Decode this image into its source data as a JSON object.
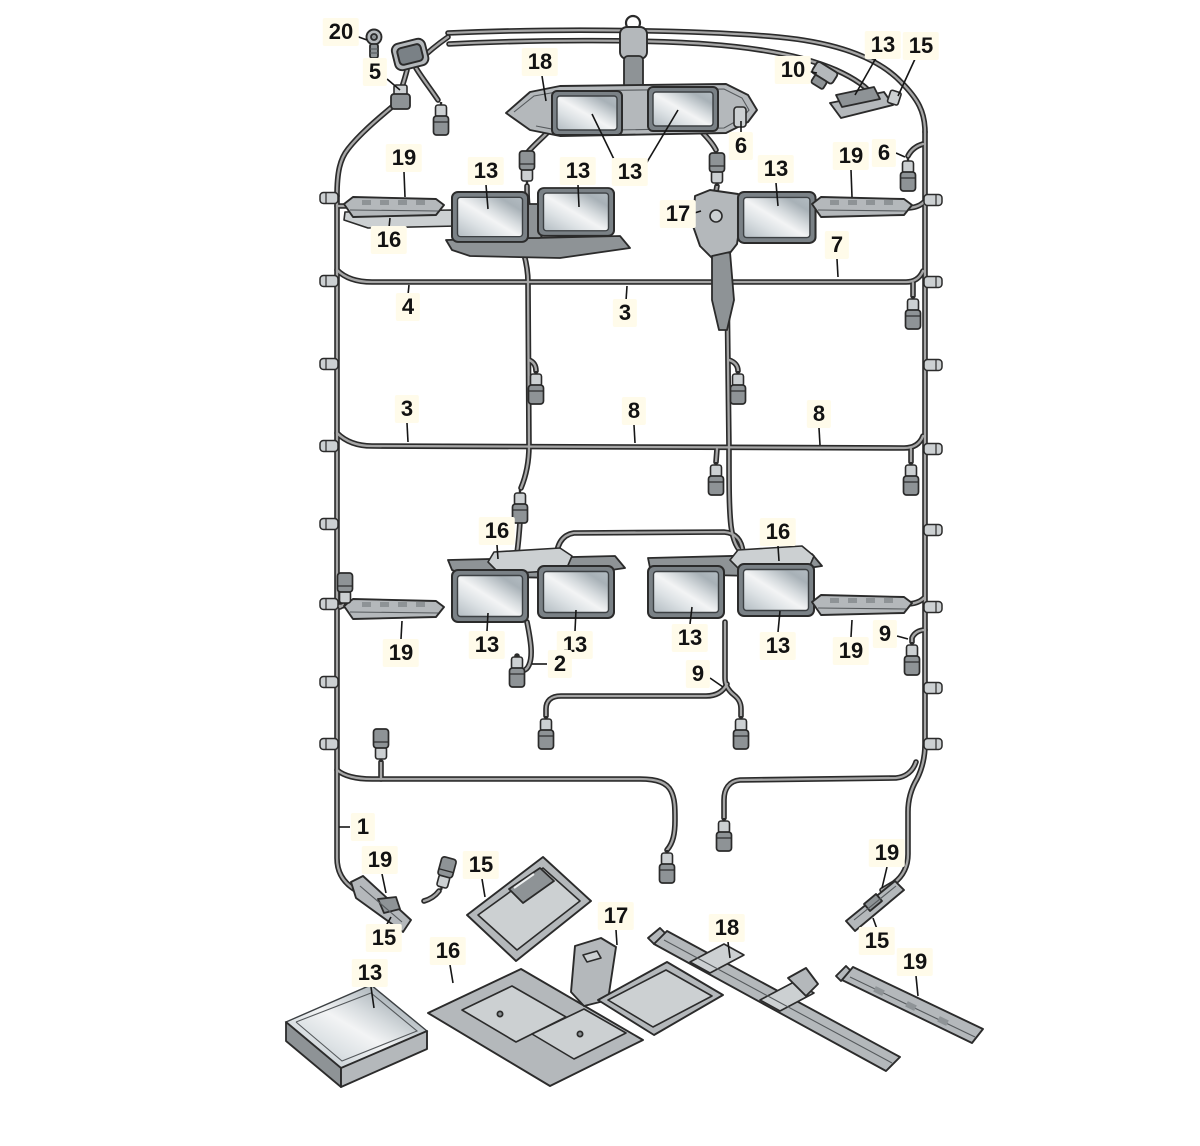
{
  "figure": {
    "kind": "exploded-parts-diagram",
    "subject": "roof wiring harness with modules, trays and mounting rails",
    "canvas": {
      "width": 1200,
      "height": 1146
    },
    "background": "#ffffff"
  },
  "palette": {
    "line": "#2b2b2b",
    "line_soft": "#55595c",
    "wire_core": "#a6a6a6",
    "part": "#b4b8bb",
    "part_light": "#ccd0d2",
    "part_dark": "#8e9396",
    "frame": "#7a8186",
    "glass_a": "#f3f4f5",
    "glass_b": "#dde2e5",
    "glass_c": "#b3bcc2",
    "glass_d": "#d6dbde",
    "glass_e": "#a8b1b7",
    "label_bg": "#fffbea",
    "label_color": "#121212"
  },
  "callouts": [
    {
      "part": "20",
      "x": 341,
      "y": 32,
      "leaders": [
        [
          [
            356,
            36
          ],
          [
            367,
            40
          ]
        ]
      ]
    },
    {
      "part": "5",
      "x": 375,
      "y": 72,
      "leaders": [
        [
          [
            387,
            79
          ],
          [
            400,
            90
          ]
        ]
      ]
    },
    {
      "part": "18",
      "x": 540,
      "y": 62,
      "leaders": [
        [
          [
            542,
            76
          ],
          [
            546,
            101
          ]
        ]
      ]
    },
    {
      "part": "10",
      "x": 793,
      "y": 70,
      "leaders": [
        [
          [
            806,
            71
          ],
          [
            817,
            73
          ]
        ]
      ]
    },
    {
      "part": "13",
      "x": 883,
      "y": 45,
      "leaders": [
        [
          [
            876,
            58
          ],
          [
            855,
            95
          ]
        ]
      ]
    },
    {
      "part": "15",
      "x": 921,
      "y": 46,
      "leaders": [
        [
          [
            915,
            59
          ],
          [
            898,
            96
          ]
        ]
      ]
    },
    {
      "part": "6",
      "x": 741,
      "y": 146,
      "leaders": [
        [
          [
            741,
            134
          ],
          [
            741,
            121
          ]
        ]
      ]
    },
    {
      "part": "19",
      "x": 404,
      "y": 158,
      "leaders": [
        [
          [
            404,
            172
          ],
          [
            405,
            197
          ]
        ]
      ]
    },
    {
      "part": "13",
      "x": 486,
      "y": 171,
      "leaders": [
        [
          [
            486,
            185
          ],
          [
            488,
            209
          ]
        ]
      ]
    },
    {
      "part": "13",
      "x": 578,
      "y": 171,
      "leaders": [
        [
          [
            578,
            185
          ],
          [
            579,
            207
          ]
        ]
      ]
    },
    {
      "part": "13",
      "x": 630,
      "y": 172,
      "leaders": [
        [
          [
            626,
            184
          ],
          [
            592,
            114
          ]
        ],
        [
          [
            634,
            184
          ],
          [
            678,
            110
          ]
        ]
      ]
    },
    {
      "part": "17",
      "x": 678,
      "y": 214,
      "leaders": [
        [
          [
            691,
            214
          ],
          [
            701,
            211
          ]
        ]
      ]
    },
    {
      "part": "13",
      "x": 776,
      "y": 169,
      "leaders": [
        [
          [
            776,
            183
          ],
          [
            778,
            206
          ]
        ]
      ]
    },
    {
      "part": "19",
      "x": 851,
      "y": 156,
      "leaders": [
        [
          [
            851,
            170
          ],
          [
            852,
            197
          ]
        ]
      ]
    },
    {
      "part": "6",
      "x": 884,
      "y": 153,
      "leaders": [
        [
          [
            896,
            153
          ],
          [
            905,
            157
          ]
        ]
      ]
    },
    {
      "part": "16",
      "x": 389,
      "y": 240,
      "leaders": [
        [
          [
            389,
            228
          ],
          [
            390,
            218
          ]
        ]
      ]
    },
    {
      "part": "7",
      "x": 837,
      "y": 245,
      "leaders": [
        [
          [
            837,
            259
          ],
          [
            838,
            277
          ]
        ]
      ]
    },
    {
      "part": "4",
      "x": 408,
      "y": 307,
      "leaders": [
        [
          [
            408,
            295
          ],
          [
            409,
            285
          ]
        ]
      ]
    },
    {
      "part": "3",
      "x": 625,
      "y": 313,
      "leaders": [
        [
          [
            626,
            301
          ],
          [
            627,
            286
          ]
        ]
      ]
    },
    {
      "part": "3",
      "x": 407,
      "y": 409,
      "leaders": [
        [
          [
            407,
            423
          ],
          [
            408,
            442
          ]
        ]
      ]
    },
    {
      "part": "8",
      "x": 634,
      "y": 411,
      "leaders": [
        [
          [
            634,
            425
          ],
          [
            635,
            443
          ]
        ]
      ]
    },
    {
      "part": "8",
      "x": 819,
      "y": 414,
      "leaders": [
        [
          [
            819,
            428
          ],
          [
            820,
            445
          ]
        ]
      ]
    },
    {
      "part": "16",
      "x": 497,
      "y": 531,
      "leaders": [
        [
          [
            497,
            545
          ],
          [
            498,
            559
          ]
        ]
      ]
    },
    {
      "part": "16",
      "x": 778,
      "y": 532,
      "leaders": [
        [
          [
            778,
            546
          ],
          [
            779,
            561
          ]
        ]
      ]
    },
    {
      "part": "19",
      "x": 401,
      "y": 653,
      "leaders": [
        [
          [
            401,
            639
          ],
          [
            402,
            621
          ]
        ]
      ]
    },
    {
      "part": "13",
      "x": 487,
      "y": 645,
      "leaders": [
        [
          [
            487,
            631
          ],
          [
            488,
            613
          ]
        ]
      ]
    },
    {
      "part": "13",
      "x": 575,
      "y": 645,
      "leaders": [
        [
          [
            575,
            631
          ],
          [
            576,
            610
          ]
        ]
      ]
    },
    {
      "part": "2",
      "x": 560,
      "y": 664,
      "leaders": [
        [
          [
            547,
            664
          ],
          [
            532,
            664
          ]
        ]
      ]
    },
    {
      "part": "13",
      "x": 690,
      "y": 638,
      "leaders": [
        [
          [
            690,
            624
          ],
          [
            692,
            607
          ]
        ]
      ]
    },
    {
      "part": "13",
      "x": 778,
      "y": 646,
      "leaders": [
        [
          [
            778,
            632
          ],
          [
            780,
            611
          ]
        ]
      ]
    },
    {
      "part": "19",
      "x": 851,
      "y": 651,
      "leaders": [
        [
          [
            851,
            637
          ],
          [
            852,
            620
          ]
        ]
      ]
    },
    {
      "part": "9",
      "x": 885,
      "y": 634,
      "leaders": [
        [
          [
            897,
            636
          ],
          [
            908,
            639
          ]
        ]
      ]
    },
    {
      "part": "9",
      "x": 698,
      "y": 674,
      "leaders": [
        [
          [
            710,
            678
          ],
          [
            723,
            687
          ]
        ]
      ]
    },
    {
      "part": "1",
      "x": 363,
      "y": 827,
      "leaders": [
        [
          [
            350,
            827
          ],
          [
            339,
            827
          ]
        ]
      ]
    },
    {
      "part": "19",
      "x": 380,
      "y": 860,
      "leaders": [
        [
          [
            382,
            874
          ],
          [
            386,
            893
          ]
        ]
      ]
    },
    {
      "part": "15",
      "x": 384,
      "y": 938,
      "leaders": [
        [
          [
            386,
            926
          ],
          [
            391,
            917
          ]
        ]
      ]
    },
    {
      "part": "15",
      "x": 481,
      "y": 865,
      "leaders": [
        [
          [
            482,
            879
          ],
          [
            485,
            897
          ]
        ]
      ]
    },
    {
      "part": "16",
      "x": 448,
      "y": 951,
      "leaders": [
        [
          [
            450,
            965
          ],
          [
            453,
            983
          ]
        ]
      ]
    },
    {
      "part": "13",
      "x": 370,
      "y": 973,
      "leaders": [
        [
          [
            371,
            987
          ],
          [
            374,
            1008
          ]
        ]
      ]
    },
    {
      "part": "17",
      "x": 616,
      "y": 916,
      "leaders": [
        [
          [
            616,
            930
          ],
          [
            617,
            945
          ]
        ]
      ]
    },
    {
      "part": "18",
      "x": 727,
      "y": 928,
      "leaders": [
        [
          [
            728,
            942
          ],
          [
            730,
            958
          ]
        ]
      ]
    },
    {
      "part": "19",
      "x": 887,
      "y": 853,
      "leaders": [
        [
          [
            887,
            867
          ],
          [
            882,
            888
          ]
        ]
      ]
    },
    {
      "part": "15",
      "x": 877,
      "y": 941,
      "leaders": [
        [
          [
            877,
            929
          ],
          [
            873,
            918
          ]
        ]
      ]
    },
    {
      "part": "19",
      "x": 915,
      "y": 962,
      "leaders": [
        [
          [
            916,
            976
          ],
          [
            918,
            996
          ]
        ]
      ]
    }
  ]
}
